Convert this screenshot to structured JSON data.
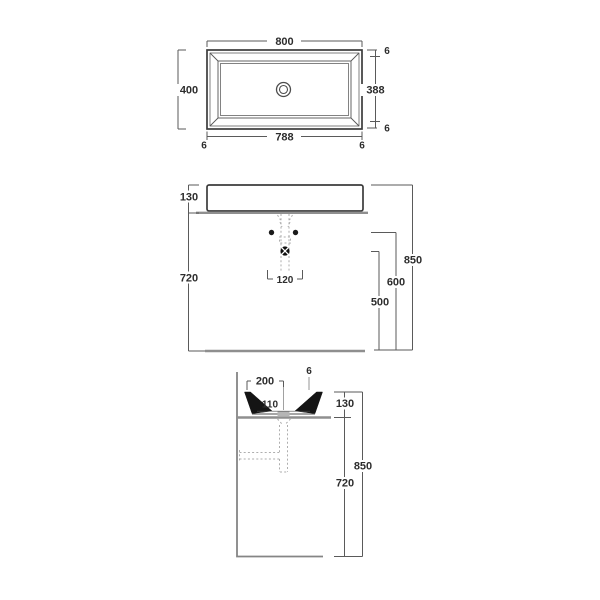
{
  "drawing": {
    "type": "washbasin-installation-drawing",
    "views": [
      "top-plan",
      "front-elevation",
      "side-section"
    ]
  },
  "top_view": {
    "outer_width": "800",
    "outer_depth": "400",
    "inner_width": "788",
    "inner_depth": "388",
    "rim_right_top": "6",
    "rim_right_bottom": "6",
    "rim_bottom_left": "6",
    "rim_bottom_right": "6"
  },
  "front_view": {
    "basin_height": "130",
    "clearance_height": "720",
    "total_height": "850",
    "supply_height": "600",
    "drain_height": "500",
    "drain_spacing": "120"
  },
  "side_view": {
    "drain_offset": "200",
    "rim_thickness": "6",
    "bowl_inner_depth": "110",
    "basin_height": "130",
    "clearance_height": "720",
    "total_height": "850"
  }
}
